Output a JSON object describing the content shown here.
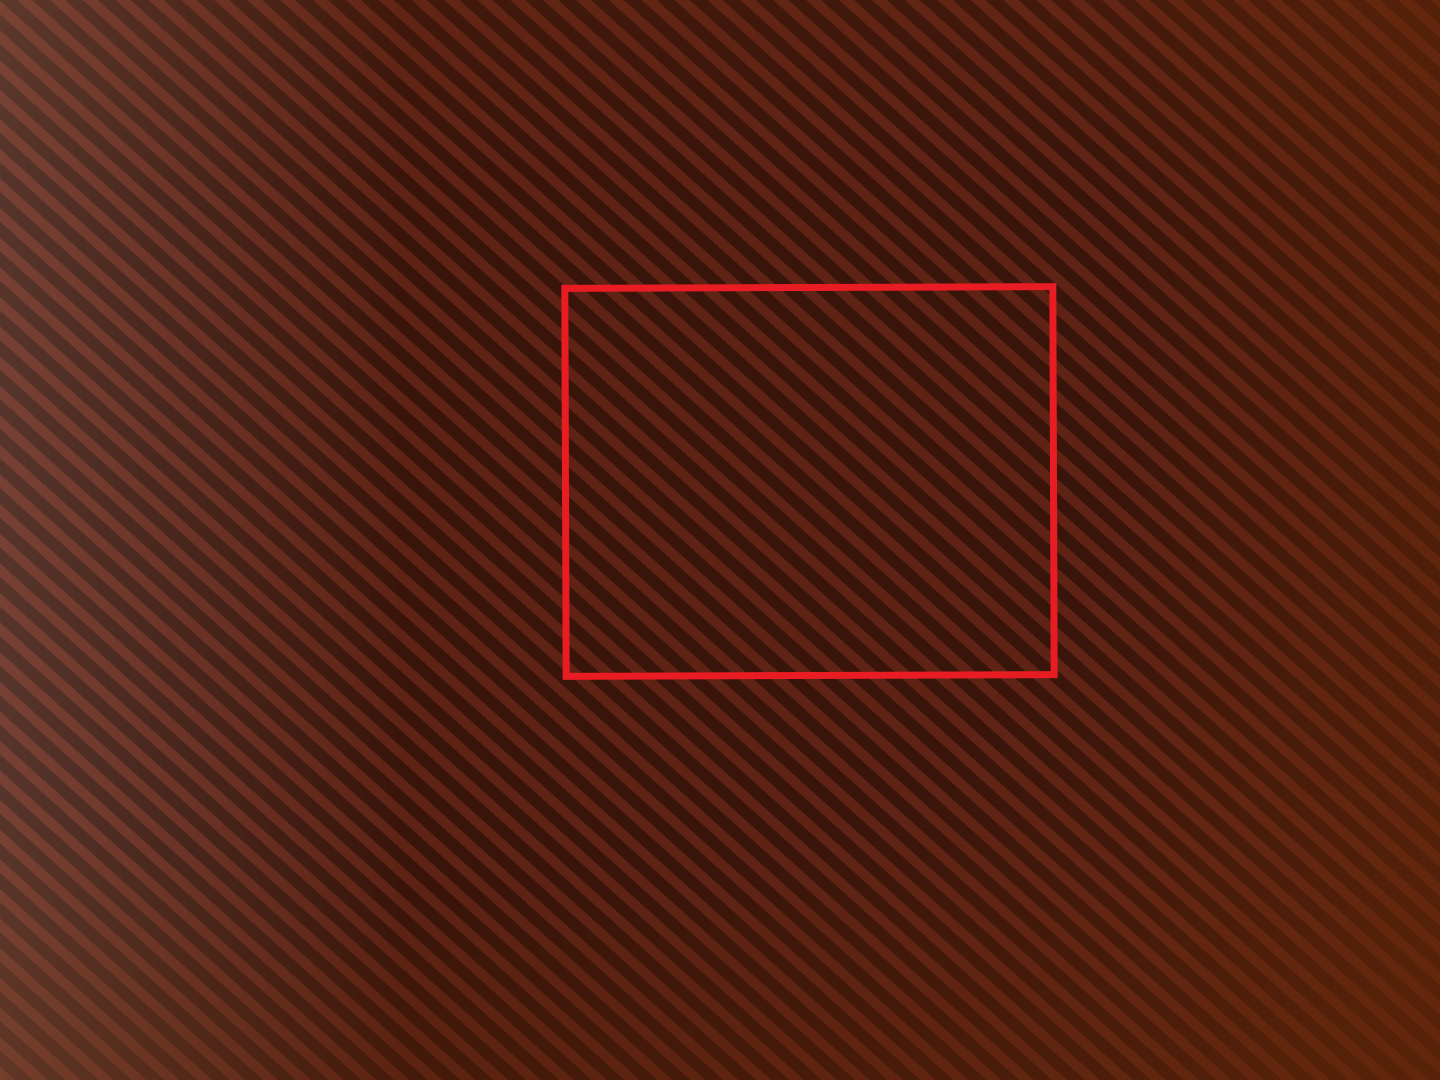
{
  "colors": {
    "annotation_red": "#e81c22",
    "paper": "#e2a779",
    "ink": "#6e3517",
    "pen": "#7c3e1d",
    "pencil": "#a06a42",
    "highlight_pink": "#de3f6e"
  },
  "margin_notes": [
    {
      "t": "Нежилое",
      "x": 163,
      "y": 82,
      "r": -85,
      "fs": 13,
      "cls": "pen faint"
    },
    {
      "t": "Уфимской",
      "x": 199,
      "y": 95,
      "r": -83,
      "fs": 13,
      "cls": "pen faint"
    },
    {
      "t": "282,4 м²  вместе с лестницей.",
      "x": 90,
      "y": 310,
      "r": -85,
      "fs": 21,
      "cls": "pen"
    },
    {
      "t": "2-й этаж",
      "x": 86,
      "y": 710,
      "r": -76,
      "fs": 17,
      "cls": "pen"
    },
    {
      "t": "Литер. В",
      "x": 84,
      "y": 902,
      "r": -76,
      "fs": 25,
      "cls": "pen"
    },
    {
      "line": true,
      "x": 106,
      "y": 775,
      "r": -86,
      "w": 350,
      "h": 7,
      "cls": "pink"
    },
    {
      "t": "2-й эт.",
      "x": 92,
      "y": 1000,
      "r": -75,
      "fs": 12,
      "cls": "pen"
    },
    {
      "t": "Башкирской",
      "x": 322,
      "y": 192,
      "r": -86,
      "fs": 19,
      "cls": "pen"
    },
    {
      "t": "МНГК.",
      "x": 392,
      "y": 230,
      "r": -82,
      "fs": 27,
      "cls": "pen"
    },
    {
      "t": "ОАО „УНЖ“",
      "x": 493,
      "y": 180,
      "r": -80,
      "fs": 25,
      "cls": "pen"
    },
    {
      "t": "Уфимское",
      "x": 552,
      "y": 176,
      "r": -78,
      "fs": 23,
      "cls": "pen"
    },
    {
      "t": "шоссе 13 А",
      "x": 608,
      "y": 172,
      "r": -75,
      "fs": 23,
      "cls": "pen"
    },
    {
      "t": "6 - туалет - 10,7 м²",
      "x": 1192,
      "y": 147,
      "r": -86,
      "fs": 19,
      "cls": "pen"
    },
    {
      "t": "9 - коридор - 41,0 м²",
      "x": 1224,
      "y": 162,
      "r": -86,
      "fs": 19,
      "cls": "pen"
    },
    {
      "t": "10 - лестн. - 18,3 м²",
      "x": 1256,
      "y": 168,
      "r": -86,
      "fs": 19,
      "cls": "pen"
    },
    {
      "t": "Пол S - 188,3",
      "x": 1308,
      "y": 210,
      "r": -86,
      "fs": 22,
      "cls": "pen"
    },
    {
      "t": "—сутр.— 182,4",
      "x": 1340,
      "y": 190,
      "r": -86,
      "fs": 14,
      "cls": "pencil"
    },
    {
      "t": "ст. Мещ. — 164,8",
      "x": 1376,
      "y": 200,
      "r": -86,
      "fs": 14,
      "cls": "pencil"
    },
    {
      "t": "2319",
      "x": 1352,
      "y": 430,
      "r": -80,
      "fs": 12,
      "cls": "pencil faint"
    },
    {
      "t": "1521",
      "x": 1342,
      "y": 468,
      "r": -80,
      "fs": 11,
      "cls": "pencil faint"
    },
    {
      "t": "566,3",
      "x": 1368,
      "y": 482,
      "r": -74,
      "fs": 15,
      "cls": "pencil"
    },
    {
      "t": "566,3 × 350 = 66 025",
      "x": 1388,
      "y": 565,
      "r": -72,
      "fs": 14,
      "cls": "pencil"
    },
    {
      "t": "Помещ. 1 помещ. — 264,4 м",
      "x": 1360,
      "y": 800,
      "r": -87,
      "fs": 13,
      "cls": "pencil faint2"
    },
    {
      "t": "Д",
      "x": 1396,
      "y": 14,
      "r": -10,
      "fs": 18,
      "cls": "pen"
    },
    {
      "t": "(несогласовано собств.)",
      "x": 1062,
      "y": 1030,
      "r": 184,
      "fs": 17,
      "cls": "pen"
    },
    {
      "t": "А",
      "x": 1133,
      "y": 1055,
      "r": 185,
      "fs": 28,
      "cls": "pen"
    },
    {
      "t": "АВЧ-изм",
      "x": 1320,
      "y": 1066,
      "r": 190,
      "fs": 12,
      "cls": "pen"
    },
    {
      "t": "5-5252",
      "x": 1330,
      "y": 1046,
      "r": 190,
      "fs": 12,
      "cls": "pen"
    }
  ],
  "plan_labels": [
    {
      "f": [
        "10",
        "18,3"
      ],
      "x": 118,
      "y": 48,
      "r": -90,
      "fs": 15
    },
    {
      "t": "6,25",
      "x": 176,
      "y": 242,
      "r": -90,
      "fs": 12
    },
    {
      "t": "2,98",
      "x": 112,
      "y": 282,
      "r": 182,
      "fs": 13
    },
    {
      "f": [
        "1",
        "17,1"
      ],
      "x": 256,
      "y": 115,
      "r": -90,
      "fs": 15
    },
    {
      "t": "6,18",
      "x": 330,
      "y": 152,
      "r": -90,
      "fs": 13
    },
    {
      "c": "1",
      "x": 280,
      "y": 255,
      "r": -80,
      "fs": 17
    },
    {
      "t": "2,8",
      "x": 288,
      "y": 288,
      "r": 182,
      "fs": 13
    },
    {
      "t": "2,95",
      "x": 432,
      "y": 48,
      "r": 182,
      "fs": 13
    },
    {
      "f": [
        "2",
        "18,2"
      ],
      "x": 418,
      "y": 180,
      "r": -90,
      "fs": 15
    },
    {
      "c": "2",
      "x": 408,
      "y": 278,
      "r": -80,
      "fs": 17
    },
    {
      "t": "6,21",
      "x": 478,
      "y": 278,
      "r": -90,
      "fs": 12
    },
    {
      "t": "2,79",
      "x": 578,
      "y": 58,
      "r": 182,
      "fs": 13
    },
    {
      "f": [
        "3",
        "17,2"
      ],
      "x": 568,
      "y": 155,
      "r": -90,
      "fs": 15
    },
    {
      "c": "3",
      "x": 568,
      "y": 292,
      "r": -80,
      "fs": 17
    },
    {
      "t": "6,21",
      "x": 618,
      "y": 278,
      "r": -90,
      "fs": 12
    },
    {
      "t": "S=53,6м",
      "x": 695,
      "y": 148,
      "r": -62,
      "fs": 21,
      "cls": "hand"
    },
    {
      "f": [
        "3ᵃ",
        "36,4"
      ],
      "x": 785,
      "y": 163,
      "r": -90,
      "fs": 15
    },
    {
      "c": "3.А",
      "x": 730,
      "y": 278,
      "r": -75,
      "fs": 16,
      "cls": "big"
    },
    {
      "t": "5,91",
      "x": 792,
      "y": 302,
      "r": 182,
      "fs": 13
    },
    {
      "t": "6,19",
      "x": 890,
      "y": 168,
      "r": -90,
      "fs": 13
    },
    {
      "t": "6,1",
      "x": 1152,
      "y": 4,
      "r": 182,
      "fs": 12
    },
    {
      "f": [
        "4",
        "37,6"
      ],
      "x": 1058,
      "y": 185,
      "r": -90,
      "fs": 15
    },
    {
      "c": "4",
      "x": 1012,
      "y": 292,
      "r": -80,
      "fs": 19,
      "cls": "big"
    },
    {
      "t": "6,22",
      "x": 1182,
      "y": 162,
      "r": -90,
      "fs": 13
    },
    {
      "f": [
        "9",
        "41,0"
      ],
      "x": 448,
      "y": 378,
      "r": 178,
      "fs": 14
    },
    {
      "t": "24,28",
      "x": 668,
      "y": 352,
      "r": 182,
      "fs": 14
    },
    {
      "t": "h=3,1",
      "x": 562,
      "y": 392,
      "r": 88,
      "fs": 13
    },
    {
      "t": "2,68",
      "x": 52,
      "y": 402,
      "r": -90,
      "fs": 12
    },
    {
      "t": "2,68",
      "x": 1178,
      "y": 412,
      "r": -90,
      "fs": 12
    },
    {
      "f": [
        "8",
        "19,8"
      ],
      "x": 172,
      "y": 508,
      "r": 178,
      "fs": 14
    },
    {
      "c": "8",
      "x": 232,
      "y": 576,
      "r": 170,
      "fs": 17
    },
    {
      "t": "6,17",
      "x": 188,
      "y": 602,
      "r": 190,
      "fs": 13
    },
    {
      "t": "3,23",
      "x": 322,
      "y": 532,
      "r": 85,
      "fs": 12
    },
    {
      "t": "3,2",
      "x": 358,
      "y": 538,
      "r": 85,
      "fs": 12
    },
    {
      "t": "1,0",
      "x": 42,
      "y": 548,
      "r": 85,
      "fs": 10
    },
    {
      "t": "0,4",
      "x": 45,
      "y": 578,
      "r": 85,
      "fs": 10
    },
    {
      "t": "38,5 м²",
      "x": 398,
      "y": 528,
      "r": 212,
      "fs": 25,
      "cls": "hand"
    },
    {
      "f": [
        "8",
        "18,7"
      ],
      "x": 492,
      "y": 508,
      "r": 178,
      "fs": 14
    },
    {
      "c": "8",
      "x": 478,
      "y": 572,
      "r": 170,
      "fs": 17
    },
    {
      "t": "6,5",
      "x": 512,
      "y": 598,
      "r": 190,
      "fs": 13
    },
    {
      "t": "СУПРИМ",
      "x": 690,
      "y": 522,
      "r": 180,
      "fs": 12,
      "cls": "vert"
    },
    {
      "c": "7",
      "x": 658,
      "y": 497,
      "r": 170,
      "fs": 14
    },
    {
      "o": "5,9",
      "x": 662,
      "y": 537,
      "r": 170,
      "fs": 12
    },
    {
      "o": "2,8 м²",
      "x": 650,
      "y": 585,
      "r": 215,
      "fs": 10
    },
    {
      "t": "1,79",
      "x": 688,
      "y": 602,
      "r": 182,
      "fs": 11
    },
    {
      "t": "3,31",
      "x": 640,
      "y": 532,
      "r": 85,
      "fs": 11
    },
    {
      "f": [
        "в",
        "5,8"
      ],
      "x": 772,
      "y": 503,
      "r": 178,
      "fs": 13
    },
    {
      "t": "1,8",
      "x": 732,
      "y": 527,
      "r": 85,
      "fs": 10
    },
    {
      "t": "2,0",
      "x": 784,
      "y": 532,
      "r": 85,
      "fs": 10
    },
    {
      "t": "1,17",
      "x": 752,
      "y": 582,
      "r": 85,
      "fs": 10
    },
    {
      "t": "1,17",
      "x": 804,
      "y": 582,
      "r": 85,
      "fs": 10
    },
    {
      "t": "0,9",
      "x": 737,
      "y": 608,
      "r": 182,
      "fs": 10
    },
    {
      "t": "0,93",
      "x": 785,
      "y": 612,
      "r": 182,
      "fs": 10
    },
    {
      "o": "10,7",
      "x": 852,
      "y": 507,
      "r": 200,
      "fs": 14
    },
    {
      "t": "4,9",
      "x": 879,
      "y": 539,
      "r": 85,
      "fs": 10
    },
    {
      "t": "3,17",
      "x": 837,
      "y": 562,
      "r": 85,
      "fs": 10
    },
    {
      "c": "6",
      "x": 872,
      "y": 580,
      "r": 170,
      "fs": 16
    },
    {
      "t": "1,56",
      "x": 872,
      "y": 604,
      "r": 182,
      "fs": 10
    },
    {
      "f": [
        "а",
        "5,9"
      ],
      "x": 954,
      "y": 522,
      "r": 178,
      "fs": 13
    },
    {
      "t": "3,18",
      "x": 989,
      "y": 572,
      "r": 85,
      "fs": 11
    },
    {
      "t": "1,87",
      "x": 965,
      "y": 607,
      "r": 182,
      "fs": 11
    },
    {
      "c": "5",
      "x": 1032,
      "y": 567,
      "r": 170,
      "fs": 19,
      "cls": "big"
    },
    {
      "t": "1,83",
      "x": 1049,
      "y": 606,
      "r": 182,
      "fs": 11
    },
    {
      "f": [
        "а",
        "5,8"
      ],
      "x": 1060,
      "y": 517,
      "r": 178,
      "fs": 13
    },
    {
      "t": "3,19",
      "x": 1080,
      "y": 577,
      "r": 85,
      "fs": 11
    },
    {
      "o": "11,4 м²",
      "x": 1117,
      "y": 547,
      "r": 248,
      "fs": 14,
      "cls": "hand"
    },
    {
      "t": "1,85",
      "x": 1120,
      "y": 607,
      "r": 182,
      "fs": 11
    },
    {
      "f": [
        "а",
        "5,7"
      ],
      "x": 1154,
      "y": 522,
      "r": 178,
      "fs": 13
    },
    {
      "t": "3,18",
      "x": 1184,
      "y": 572,
      "r": 85,
      "fs": 11
    },
    {
      "t": "0,4",
      "x": 1160,
      "y": 614,
      "r": 182,
      "fs": 10
    },
    {
      "t": "1,0",
      "x": 1178,
      "y": 614,
      "r": 182,
      "fs": 10
    }
  ]
}
